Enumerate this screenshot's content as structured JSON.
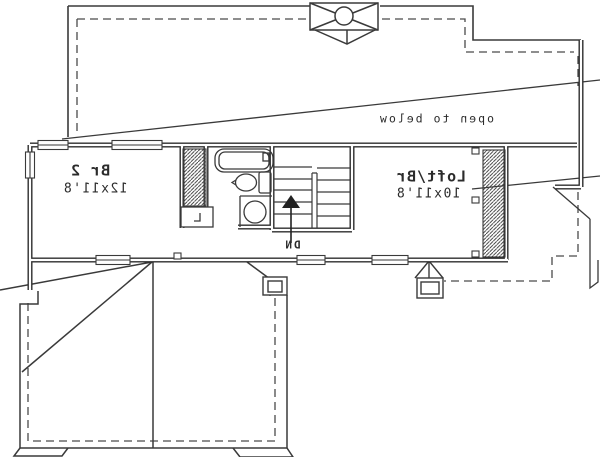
{
  "drawing": {
    "title": "second-floor-plan (mirrored print)",
    "labels": {
      "br2_name": "Br 2",
      "br2_dims": "12x11'8",
      "loft_name": "Loft/Br",
      "loft_dims": "10x11'8",
      "open_to_below": "open to below",
      "stair_direction": "DN"
    },
    "colors": {
      "background": "#ffffff",
      "line": "#3a3a3a",
      "wall": "#2e2e2e",
      "dashed_overhang": "#4a4a4a"
    }
  }
}
